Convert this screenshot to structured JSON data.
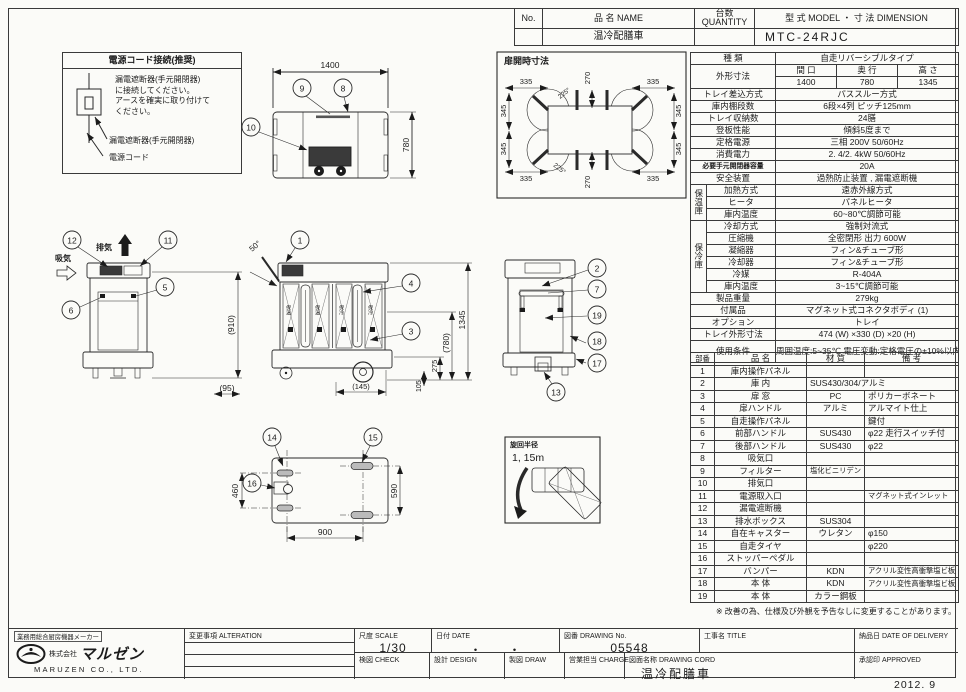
{
  "header": {
    "no_label": "No.",
    "name_label": "品  名 NAME",
    "qty_label": "台数 QUANTITY",
    "model_label": "型 式 MODEL   ・  寸 法 DIMENSION",
    "product_name": "温冷配膳車",
    "model_value": "MTC-24RJC"
  },
  "power_note": {
    "title": "電源コード接続(推奨)",
    "body": "漏電遮断器(手元開閉器)\nに接続してください。\nアースを確実に取り付けて\nください。",
    "label_breaker": "漏電遮断器(手元開閉器)",
    "label_cord": "電源コード"
  },
  "drawings": {
    "top_view": {
      "dim_width": "1400",
      "dim_depth": "780",
      "callout_9": "9",
      "callout_8": "8",
      "callout_10": "10"
    },
    "door_open": {
      "title": "扉開時寸法",
      "dim_335": "335",
      "dim_270": "270",
      "dim_345": "345",
      "dim_angle": "225°"
    },
    "rear_view": {
      "exhaust_label": "排気",
      "intake_label": "吸気",
      "dim_height": "(910)",
      "dim_offset": "(95)",
      "callout_12": "12",
      "callout_11": "11",
      "callout_5": "5",
      "callout_6": "6"
    },
    "front_view": {
      "dim_height": "1345",
      "dim_inner": "(780)",
      "dim_275": "275",
      "dim_105": "105",
      "dim_145": "(145)",
      "door_angle": "50°",
      "label_hot": "保温",
      "label_cold": "保冷",
      "callout_1": "1",
      "callout_4": "4",
      "callout_3": "3"
    },
    "side_view": {
      "callout_2": "2",
      "callout_7": "7",
      "callout_19": "19",
      "callout_18": "18",
      "callout_17": "17",
      "callout_13": "13"
    },
    "plan_view": {
      "dim_460": "460",
      "dim_590": "590",
      "dim_900": "900",
      "callout_14": "14",
      "callout_15": "15",
      "callout_16": "16"
    },
    "turning": {
      "title": "旋回半径",
      "value": "1, 15m"
    }
  },
  "spec": {
    "kind": {
      "label": "種  類",
      "value": "自走リバーシブルタイプ"
    },
    "outer": {
      "label": "外形寸法",
      "w_label": "間 口",
      "d_label": "奥 行",
      "h_label": "高 さ",
      "w": "1400",
      "d": "780",
      "h": "1345"
    },
    "tray_insert": {
      "label": "トレイ差込方式",
      "value": "パススルー方式"
    },
    "shelves": {
      "label": "庫内棚段数",
      "value": "6段×4列 ピッチ125mm"
    },
    "tray_count": {
      "label": "トレイ収納数",
      "value": "24膳"
    },
    "climb": {
      "label": "登板性能",
      "value": "傾斜5度まで"
    },
    "power": {
      "label": "定格電源",
      "value": "三相 200V 50/60Hz"
    },
    "consumption": {
      "label": "消費電力",
      "value": "2. 4/2. 4kW 50/60Hz"
    },
    "breaker": {
      "label": "必要手元開閉器容量",
      "value": "20A"
    },
    "safety": {
      "label": "安全装置",
      "value": "過熱防止装置 , 漏電遮断機"
    },
    "hot_group": "保温庫",
    "heating": {
      "label": "加熱方式",
      "value": "遠赤外線方式"
    },
    "heater": {
      "label": "ヒータ",
      "value": "パネルヒータ"
    },
    "hot_temp": {
      "label": "庫内温度",
      "value": "60~80℃調節可能"
    },
    "cold_group": "保冷庫",
    "cooling": {
      "label": "冷却方式",
      "value": "強制対流式"
    },
    "compressor": {
      "label": "圧縮機",
      "value": "全密閉形 出力 600W"
    },
    "condenser": {
      "label": "凝縮器",
      "value": "フィン&チューブ形"
    },
    "cooler": {
      "label": "冷却器",
      "value": "フィン&チューブ形"
    },
    "refrigerant": {
      "label": "冷媒",
      "value": "R-404A"
    },
    "cold_temp": {
      "label": "庫内温度",
      "value": "3~15℃調節可能"
    },
    "weight": {
      "label": "製品重量",
      "value": "279kg"
    },
    "accessory": {
      "label": "付属品",
      "value": "マグネット式コネクタボディ (1)"
    },
    "option": {
      "label": "オプション",
      "value": "トレイ"
    },
    "tray_size": {
      "label": "トレイ外形寸法",
      "value": "474 (W) ×330 (D) ×20 (H)"
    },
    "conditions": {
      "label": "使用条件",
      "value": "周囲温度:5~35℃\n電圧変動:定格電圧の±10%以内"
    }
  },
  "parts": {
    "headers": {
      "no": "部番",
      "name": "品  名",
      "material": "材 質",
      "remark": "備  考"
    },
    "rows": [
      {
        "no": "1",
        "name": "庫内操作パネル",
        "mat": "",
        "note": ""
      },
      {
        "no": "2",
        "name": "庫 内",
        "mat": "SUS430/304/アルミ",
        "note": ""
      },
      {
        "no": "3",
        "name": "扉 窓",
        "mat": "PC",
        "note": "ポリカーボネート"
      },
      {
        "no": "4",
        "name": "扉ハンドル",
        "mat": "アルミ",
        "note": "アルマイト仕上"
      },
      {
        "no": "5",
        "name": "自走操作パネル",
        "mat": "",
        "note": "鍵付"
      },
      {
        "no": "6",
        "name": "前部ハンドル",
        "mat": "SUS430",
        "note": "φ22 走行スイッチ付"
      },
      {
        "no": "7",
        "name": "後部ハンドル",
        "mat": "SUS430",
        "note": "φ22"
      },
      {
        "no": "8",
        "name": "吸気口",
        "mat": "",
        "note": ""
      },
      {
        "no": "9",
        "name": "フィルター",
        "mat": "塩化ビニリデン",
        "note": ""
      },
      {
        "no": "10",
        "name": "排気口",
        "mat": "",
        "note": ""
      },
      {
        "no": "11",
        "name": "電源取入口",
        "mat": "",
        "note": "マグネット式インレット"
      },
      {
        "no": "12",
        "name": "漏電遮断機",
        "mat": "",
        "note": ""
      },
      {
        "no": "13",
        "name": "排水ボックス",
        "mat": "SUS304",
        "note": ""
      },
      {
        "no": "14",
        "name": "自在キャスター",
        "mat": "ウレタン",
        "note": "φ150"
      },
      {
        "no": "15",
        "name": "自走タイヤ",
        "mat": "",
        "note": "φ220"
      },
      {
        "no": "16",
        "name": "ストッパーペダル",
        "mat": "",
        "note": ""
      },
      {
        "no": "17",
        "name": "バンパー",
        "mat": "KDN",
        "note": "アクリル変性高衝撃塩ビ板"
      },
      {
        "no": "18",
        "name": "本 体",
        "mat": "KDN",
        "note": "アクリル変性高衝撃塩ビ板"
      },
      {
        "no": "19",
        "name": "本 体",
        "mat": "カラー鋼板",
        "note": ""
      }
    ]
  },
  "note": "※ 改善の為、仕様及び外観を予告なしに変更することがあります。",
  "titleblock": {
    "alteration_label": "変更事項 ALTERATION",
    "scale_label": "尺度 SCALE",
    "scale_value": "1/30",
    "date_label": "日付 DATE",
    "date_value": "・　　・",
    "drawing_no_label": "図番 DRAWING No.",
    "drawing_no_value": "05548",
    "title_label": "工事名 TITLE",
    "delivery_label": "納品日 DATE OF DELIVERY",
    "check_label": "検図 CHECK",
    "design_label": "設計 DESIGN",
    "draw_label": "製図 DRAW",
    "charge_label": "営業担当 CHARGE",
    "drawing_name_label": "図面名称 DRAWING CORD",
    "drawing_name_value": "温冷配膳車",
    "approved_label": "承認印 APPROVED",
    "issue_date": "2012. 9"
  },
  "company": {
    "tagline": "業務用総合厨房機器メーカー",
    "name_prefix": "株式会社",
    "name": "マルゼン",
    "name_en": "MARUZEN  CO., LTD."
  }
}
